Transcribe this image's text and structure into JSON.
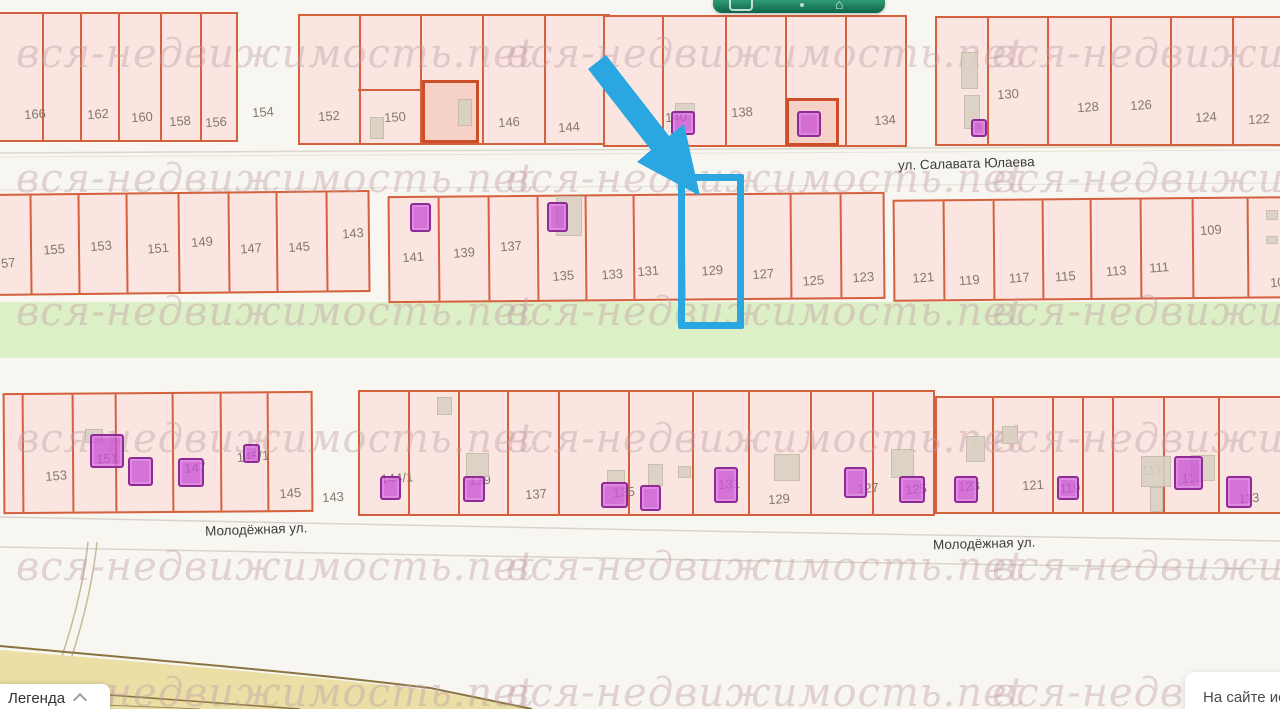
{
  "watermark": {
    "text": "вся-недвижимость.net",
    "color": "#c5a0aa",
    "columns": [
      16,
      506,
      992
    ],
    "rows": [
      57,
      182,
      315,
      442,
      570,
      696
    ]
  },
  "toolbar": {
    "icons": [
      "rounded-rect-icon",
      "dot-icon",
      "house-icon"
    ],
    "color": "#0c654a"
  },
  "legend": {
    "label": "Легенда",
    "chevron_icon": "chevron-up-icon"
  },
  "tooltip": {
    "text": "На сайте ис"
  },
  "highlight": {
    "parcel": "129",
    "color": "#2aa7e1",
    "annotation": "arrow-pointing-to-parcel-129"
  },
  "map": {
    "street_labels": [
      {
        "name": "ул. Салавата Юлаева",
        "x": 898,
        "y": 156,
        "rot": -1.5
      },
      {
        "name": "Молодёжная ул.",
        "x": 205,
        "y": 522,
        "rot": -2
      },
      {
        "name": "Молодёжная ул.",
        "x": 933,
        "y": 536,
        "rot": -1.5
      }
    ],
    "outside_labels": [
      {
        "text": "154",
        "x": 263,
        "y": 112
      },
      {
        "text": "143",
        "x": 333,
        "y": 497
      }
    ],
    "blocks": [
      {
        "id": "A",
        "x": -8,
        "y": 12,
        "w": 246,
        "h": 130,
        "tilt": 0,
        "cells": [
          {
            "label": "166",
            "x": 0,
            "w": 50,
            "lx": 41,
            "ly": 100
          },
          {
            "label": "",
            "x": 50,
            "w": 38
          },
          {
            "label": "162",
            "x": 88,
            "w": 38,
            "lx": 104,
            "ly": 100
          },
          {
            "label": "160",
            "x": 126,
            "w": 42,
            "lx": 148,
            "ly": 103
          },
          {
            "label": "158",
            "x": 168,
            "w": 40,
            "lx": 186,
            "ly": 107
          },
          {
            "label": "156",
            "x": 208,
            "w": 38,
            "lx": 222,
            "ly": 108
          }
        ]
      },
      {
        "id": "B",
        "x": 298,
        "y": 14,
        "w": 312,
        "h": 131,
        "tilt": 0,
        "cells": [
          {
            "label": "152",
            "x": 0,
            "w": 61,
            "lx": 29,
            "ly": 100
          },
          {
            "label": "150",
            "x": 61,
            "w": 61,
            "lx": 95,
            "ly": 101
          },
          {
            "label": "148",
            "x": 122,
            "w": 62,
            "lx": 168,
            "ly": 101
          },
          {
            "label": "146",
            "x": 184,
            "w": 62,
            "lx": 209,
            "ly": 106
          },
          {
            "label": "144",
            "x": 246,
            "w": 66,
            "lx": 269,
            "ly": 111
          }
        ]
      },
      {
        "id": "C",
        "x": 603,
        "y": 15,
        "w": 304,
        "h": 132,
        "tilt": 0,
        "cells": [
          {
            "label": "",
            "x": 0,
            "w": 59
          },
          {
            "label": "140",
            "x": 59,
            "w": 63,
            "lx": 71,
            "ly": 100
          },
          {
            "label": "138",
            "x": 122,
            "w": 60,
            "lx": 137,
            "ly": 95
          },
          {
            "label": "136",
            "x": 182,
            "w": 60,
            "lx": 211,
            "ly": 103
          },
          {
            "label": "134",
            "x": 242,
            "w": 62,
            "lx": 280,
            "ly": 103
          }
        ]
      },
      {
        "id": "D",
        "x": 935,
        "y": 16,
        "w": 350,
        "h": 130,
        "tilt": 0,
        "cells": [
          {
            "label": "",
            "x": 0,
            "w": 52
          },
          {
            "label": "130",
            "x": 52,
            "w": 60,
            "lx": 71,
            "ly": 76
          },
          {
            "label": "128",
            "x": 112,
            "w": 63,
            "lx": 151,
            "ly": 89
          },
          {
            "label": "126",
            "x": 175,
            "w": 60,
            "lx": 204,
            "ly": 87
          },
          {
            "label": "124",
            "x": 235,
            "w": 62,
            "lx": 269,
            "ly": 99
          },
          {
            "label": "122",
            "x": 297,
            "w": 53,
            "lx": 322,
            "ly": 101
          }
        ]
      },
      {
        "id": "E",
        "x": -12,
        "y": 192,
        "w": 382,
        "h": 102,
        "tilt": -0.6,
        "cells": [
          {
            "label": "57",
            "x": 0,
            "w": 42,
            "lx": 18,
            "ly": 67
          },
          {
            "label": "155",
            "x": 42,
            "w": 48,
            "lx": 64,
            "ly": 54
          },
          {
            "label": "153",
            "x": 90,
            "w": 48,
            "lx": 111,
            "ly": 51
          },
          {
            "label": "151",
            "x": 138,
            "w": 52,
            "lx": 168,
            "ly": 54
          },
          {
            "label": "149",
            "x": 190,
            "w": 50,
            "lx": 212,
            "ly": 48
          },
          {
            "label": "147",
            "x": 240,
            "w": 48,
            "lx": 261,
            "ly": 55
          },
          {
            "label": "145",
            "x": 288,
            "w": 50,
            "lx": 309,
            "ly": 54
          },
          {
            "label": "143",
            "x": 338,
            "w": 44,
            "lx": 363,
            "ly": 41
          }
        ]
      },
      {
        "id": "F",
        "x": 388,
        "y": 194,
        "w": 497,
        "h": 107,
        "tilt": -0.5,
        "cells": [
          {
            "label": "141",
            "x": 0,
            "w": 50,
            "lx": 23,
            "ly": 59
          },
          {
            "label": "139",
            "x": 50,
            "w": 50,
            "lx": 74,
            "ly": 55
          },
          {
            "label": "137",
            "x": 100,
            "w": 49,
            "lx": 121,
            "ly": 49
          },
          {
            "label": "135",
            "x": 149,
            "w": 48,
            "lx": 173,
            "ly": 79
          },
          {
            "label": "133",
            "x": 197,
            "w": 48,
            "lx": 222,
            "ly": 78
          },
          {
            "label": "131",
            "x": 245,
            "w": 50,
            "lx": 258,
            "ly": 75
          },
          {
            "label": "129",
            "x": 295,
            "w": 57,
            "lx": 322,
            "ly": 75
          },
          {
            "label": "127",
            "x": 352,
            "w": 50,
            "lx": 373,
            "ly": 79
          },
          {
            "label": "125",
            "x": 402,
            "w": 50,
            "lx": 423,
            "ly": 86
          },
          {
            "label": "123",
            "x": 452,
            "w": 45,
            "lx": 473,
            "ly": 83
          }
        ]
      },
      {
        "id": "G",
        "x": 893,
        "y": 198,
        "w": 392,
        "h": 102,
        "tilt": -0.5,
        "cells": [
          {
            "label": "121",
            "x": 0,
            "w": 50,
            "lx": 28,
            "ly": 76
          },
          {
            "label": "119",
            "x": 50,
            "w": 50,
            "lx": 74,
            "ly": 79
          },
          {
            "label": "117",
            "x": 100,
            "w": 49,
            "lx": 124,
            "ly": 77
          },
          {
            "label": "115",
            "x": 149,
            "w": 48,
            "lx": 170,
            "ly": 76
          },
          {
            "label": "113",
            "x": 197,
            "w": 50,
            "lx": 221,
            "ly": 71
          },
          {
            "label": "111",
            "x": 247,
            "w": 52,
            "lx": 264,
            "ly": 68
          },
          {
            "label": "109",
            "x": 299,
            "w": 55,
            "lx": 316,
            "ly": 31
          },
          {
            "label": "10",
            "x": 354,
            "w": 38,
            "lx": 382,
            "ly": 84
          }
        ]
      },
      {
        "id": "H",
        "x": 3,
        "y": 392,
        "w": 310,
        "h": 121,
        "tilt": -0.4,
        "cells": [
          {
            "label": "",
            "x": 0,
            "w": 19
          },
          {
            "label": "153",
            "x": 19,
            "w": 50,
            "lx": 51,
            "ly": 81
          },
          {
            "label": "151",
            "x": 69,
            "w": 43,
            "lx": 102,
            "ly": 64
          },
          {
            "label": "",
            "x": 112,
            "w": 57
          },
          {
            "label": "147",
            "x": 169,
            "w": 48,
            "lx": 190,
            "ly": 74
          },
          {
            "label": "145/1",
            "x": 217,
            "w": 47,
            "lx": 248,
            "ly": 63
          },
          {
            "label": "145",
            "x": 264,
            "w": 46,
            "lx": 285,
            "ly": 100
          }
        ]
      },
      {
        "id": "I",
        "x": 358,
        "y": 390,
        "w": 577,
        "h": 126,
        "tilt": 0,
        "cells": [
          {
            "label": "144/1",
            "x": 0,
            "w": 50,
            "lx": 37,
            "ly": 86
          },
          {
            "label": "",
            "x": 50,
            "w": 50
          },
          {
            "label": "139",
            "x": 100,
            "w": 49,
            "lx": 120,
            "ly": 88
          },
          {
            "label": "137",
            "x": 149,
            "w": 51,
            "lx": 176,
            "ly": 102
          },
          {
            "label": "135",
            "x": 200,
            "w": 70,
            "lx": 264,
            "ly": 100
          },
          {
            "label": "",
            "x": 270,
            "w": 64
          },
          {
            "label": "131",
            "x": 334,
            "w": 56,
            "lx": 369,
            "ly": 92
          },
          {
            "label": "129",
            "x": 390,
            "w": 62,
            "lx": 419,
            "ly": 107
          },
          {
            "label": "127",
            "x": 452,
            "w": 62,
            "lx": 508,
            "ly": 96
          },
          {
            "label": "125",
            "x": 514,
            "w": 63,
            "lx": 556,
            "ly": 97
          }
        ]
      },
      {
        "id": "J",
        "x": 935,
        "y": 396,
        "w": 350,
        "h": 118,
        "tilt": 0,
        "cells": [
          {
            "label": "123",
            "x": 0,
            "w": 57,
            "lx": 32,
            "ly": 88
          },
          {
            "label": "121",
            "x": 57,
            "w": 60,
            "lx": 96,
            "ly": 87
          },
          {
            "label": "119",
            "x": 117,
            "w": 30,
            "lx": 133,
            "ly": 90
          },
          {
            "label": "",
            "x": 147,
            "w": 30
          },
          {
            "label": "117",
            "x": 177,
            "w": 51,
            "lx": 215,
            "ly": 72
          },
          {
            "label": "115",
            "x": 228,
            "w": 55,
            "lx": 255,
            "ly": 80
          },
          {
            "label": "113",
            "x": 283,
            "w": 67,
            "lx": 312,
            "ly": 100
          }
        ]
      }
    ],
    "sublots": [
      {
        "x": 422,
        "y": 80,
        "w": 57,
        "h": 63
      },
      {
        "x": 786,
        "y": 98,
        "w": 53,
        "h": 48
      }
    ],
    "divider_lines": [
      {
        "x": 358,
        "y": 89,
        "w": 62
      }
    ],
    "buildings": [
      {
        "x": 370,
        "y": 117,
        "w": 14,
        "h": 22
      },
      {
        "x": 458,
        "y": 99,
        "w": 14,
        "h": 27
      },
      {
        "x": 675,
        "y": 103,
        "w": 20,
        "h": 11
      },
      {
        "x": 961,
        "y": 52,
        "w": 17,
        "h": 37
      },
      {
        "x": 964,
        "y": 95,
        "w": 16,
        "h": 34
      },
      {
        "x": 556,
        "y": 196,
        "w": 26,
        "h": 40
      },
      {
        "x": 1266,
        "y": 210,
        "w": 12,
        "h": 10
      },
      {
        "x": 1266,
        "y": 236,
        "w": 12,
        "h": 8
      },
      {
        "x": 85,
        "y": 429,
        "w": 18,
        "h": 14
      },
      {
        "x": 437,
        "y": 397,
        "w": 15,
        "h": 18
      },
      {
        "x": 466,
        "y": 453,
        "w": 23,
        "h": 24
      },
      {
        "x": 607,
        "y": 470,
        "w": 18,
        "h": 13
      },
      {
        "x": 648,
        "y": 464,
        "w": 15,
        "h": 22
      },
      {
        "x": 678,
        "y": 466,
        "w": 13,
        "h": 12
      },
      {
        "x": 774,
        "y": 454,
        "w": 26,
        "h": 27
      },
      {
        "x": 891,
        "y": 449,
        "w": 23,
        "h": 29
      },
      {
        "x": 966,
        "y": 436,
        "w": 19,
        "h": 26
      },
      {
        "x": 1002,
        "y": 426,
        "w": 16,
        "h": 18
      },
      {
        "x": 1141,
        "y": 456,
        "w": 30,
        "h": 31
      },
      {
        "x": 1150,
        "y": 487,
        "w": 13,
        "h": 25
      },
      {
        "x": 1191,
        "y": 455,
        "w": 24,
        "h": 26
      }
    ],
    "markers": [
      {
        "x": 671,
        "y": 111,
        "w": 24,
        "h": 24
      },
      {
        "x": 797,
        "y": 111,
        "w": 24,
        "h": 26
      },
      {
        "x": 971,
        "y": 119,
        "w": 16,
        "h": 18
      },
      {
        "x": 410,
        "y": 203,
        "w": 21,
        "h": 29
      },
      {
        "x": 547,
        "y": 202,
        "w": 21,
        "h": 30
      },
      {
        "x": 90,
        "y": 434,
        "w": 34,
        "h": 34
      },
      {
        "x": 128,
        "y": 457,
        "w": 25,
        "h": 29
      },
      {
        "x": 178,
        "y": 458,
        "w": 26,
        "h": 29
      },
      {
        "x": 243,
        "y": 444,
        "w": 17,
        "h": 19
      },
      {
        "x": 380,
        "y": 476,
        "w": 21,
        "h": 24
      },
      {
        "x": 463,
        "y": 476,
        "w": 22,
        "h": 26
      },
      {
        "x": 601,
        "y": 482,
        "w": 27,
        "h": 26
      },
      {
        "x": 640,
        "y": 485,
        "w": 21,
        "h": 26
      },
      {
        "x": 714,
        "y": 467,
        "w": 24,
        "h": 36
      },
      {
        "x": 844,
        "y": 467,
        "w": 23,
        "h": 31
      },
      {
        "x": 899,
        "y": 476,
        "w": 26,
        "h": 27
      },
      {
        "x": 954,
        "y": 476,
        "w": 24,
        "h": 27
      },
      {
        "x": 1057,
        "y": 476,
        "w": 22,
        "h": 24
      },
      {
        "x": 1174,
        "y": 456,
        "w": 29,
        "h": 34
      },
      {
        "x": 1226,
        "y": 476,
        "w": 26,
        "h": 32
      }
    ]
  }
}
